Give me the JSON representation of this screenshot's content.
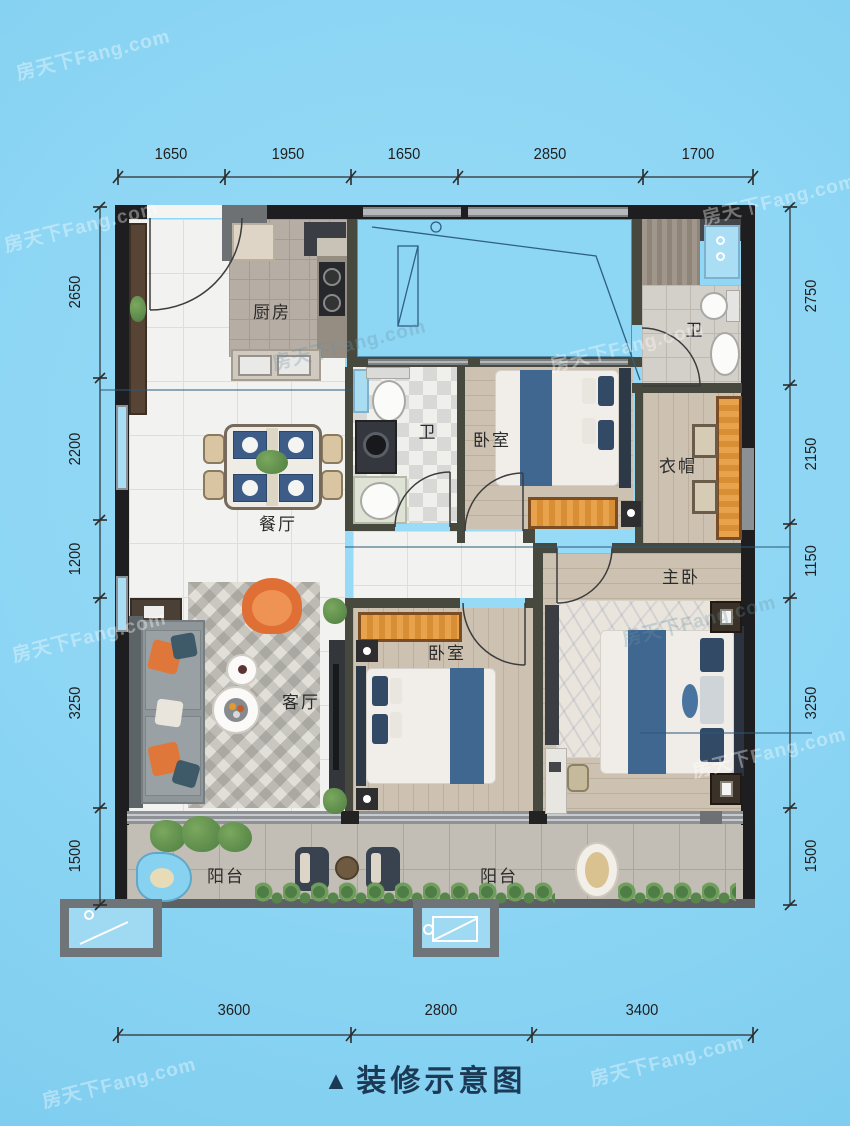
{
  "watermark": {
    "text": "房天下Fang.com"
  },
  "caption": {
    "marker": "▲",
    "text": "装修示意图"
  },
  "dimensions": {
    "top": [
      "1650",
      "1950",
      "1650",
      "2850",
      "1700"
    ],
    "left": [
      "2650",
      "2200",
      "1200",
      "3250",
      "1500"
    ],
    "right": [
      "2750",
      "2150",
      "1150",
      "3250",
      "1500"
    ],
    "bottom": [
      "3600",
      "2800",
      "3400"
    ]
  },
  "rooms": {
    "kitchen": "厨房",
    "bath_top": "卫",
    "bath_middle": "卫",
    "bedroom_upper": "卧室",
    "cloakroom": "衣帽",
    "dining": "餐厅",
    "master_bedroom": "主卧",
    "living_room": "客厅",
    "bedroom_lower": "卧室",
    "balcony_left": "阳台",
    "balcony_right": "阳台"
  },
  "colors": {
    "background_blue": "#8cd6f4",
    "exterior_wall": "#1e1e20",
    "interior_wall": "#47493f",
    "accent_orange": "#e0773a",
    "wardrobe_orange": "#e09a44",
    "bed_blue": "#40678f",
    "caption_navy": "#1c3a55",
    "dimension_text": "#1f1f1f"
  }
}
